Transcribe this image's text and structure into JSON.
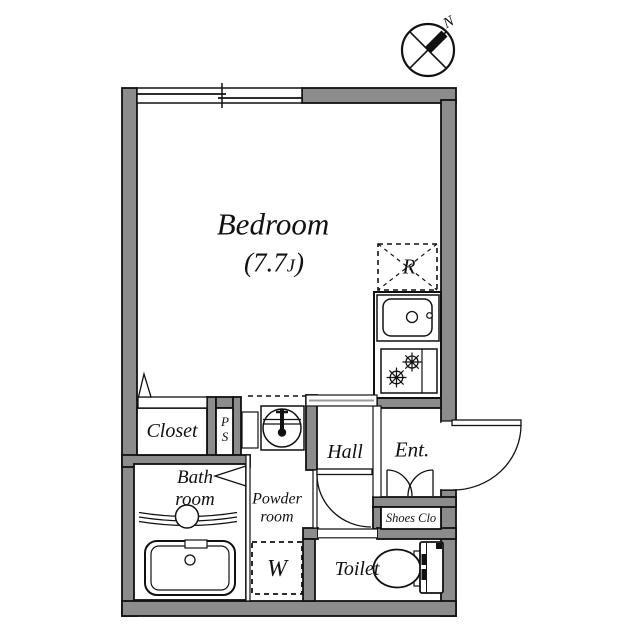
{
  "floorplan": {
    "compass": {
      "north_label": "N"
    },
    "rooms": {
      "bedroom": {
        "name": "Bedroom",
        "area_prefix": "(7.7",
        "area_unit": "J",
        "area_suffix": ")"
      },
      "closet": {
        "name": "Closet"
      },
      "pipe_space": {
        "line1": "P",
        "line2": "S"
      },
      "bathroom": {
        "line1": "Bath",
        "line2": "room"
      },
      "powder_room": {
        "line1": "Powder",
        "line2": "room"
      },
      "hall": {
        "name": "Hall"
      },
      "entrance": {
        "name": "Ent."
      },
      "shoes_closet": {
        "name": "Shoes Clo"
      },
      "toilet": {
        "name": "Toilet"
      }
    },
    "fixtures": {
      "refrigerator": {
        "label": "R"
      },
      "washer": {
        "label": "W"
      }
    },
    "colors": {
      "wall": "#8c8c8c",
      "line": "#111111",
      "background": "#ffffff"
    }
  }
}
